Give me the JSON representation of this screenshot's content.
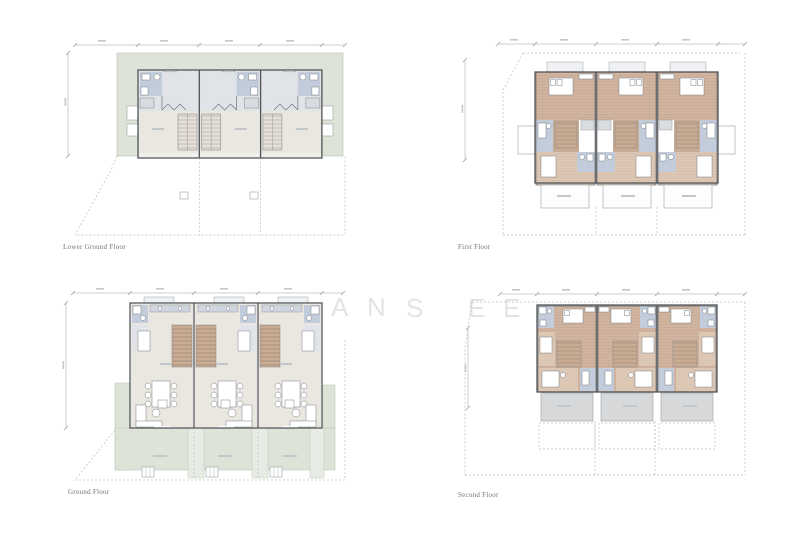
{
  "sheet": {
    "plans": [
      {
        "id": "lower-ground-floor",
        "caption": "Lower Ground Floor",
        "units": 3
      },
      {
        "id": "first-floor",
        "caption": "First Floor",
        "units": 3
      },
      {
        "id": "ground-floor",
        "caption": "Ground Floor",
        "units": 3
      },
      {
        "id": "second-floor",
        "caption": "Second Floor",
        "units": 3
      }
    ]
  },
  "watermark": {
    "letters": [
      "A",
      "N",
      "S",
      "E",
      "E"
    ]
  },
  "colors": {
    "white": "#ffffff",
    "green": "#dde4d7",
    "greenBorder": "#b7c1b1",
    "beige": "#eae6e0",
    "roomgrey": "#e0e3e7",
    "bath": "#c2ccda",
    "tan": "#d0b4a0",
    "tan2": "#dcc6b4",
    "stairs": "#c9ac94",
    "terrace": "#d6d8da",
    "wall": "#515458",
    "dim": "#9aa0a4",
    "dash": "#bcbfb8",
    "blob": "#c3c7ca",
    "caption": "#6f7376",
    "wm": "#e3e4e6",
    "driveway": "#e6ebe3"
  }
}
